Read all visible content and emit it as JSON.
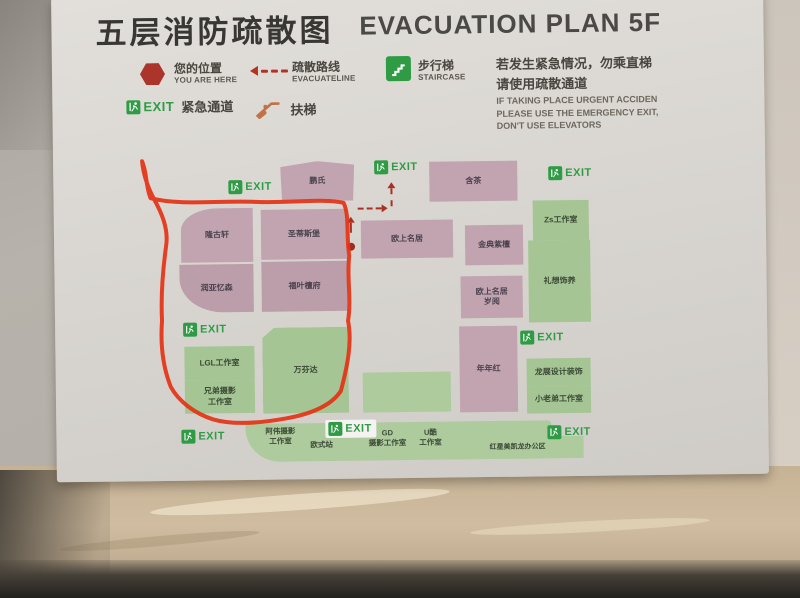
{
  "title": {
    "cn": "五层消防疏散图",
    "en": "EVACUATION PLAN 5F"
  },
  "legend": {
    "you_are_here_cn": "您的位置",
    "you_are_here_en": "YOU ARE HERE",
    "evacuate_line_cn": "疏散路线",
    "evacuate_line_en": "EVACUATELINE",
    "staircase_cn": "步行梯",
    "staircase_en": "STAIRCASE",
    "exit_word": "EXIT",
    "emergency_cn": "紧急通道",
    "escalator_cn": "扶梯"
  },
  "notice": {
    "cn": "若发生紧急情况，勿乘直梯\n请使用疏散通道",
    "en": "IF TAKING PLACE URGENT ACCIDEN\nPLEASE USE THE EMERGENCY EXIT,\nDON'T USE ELEVATORS"
  },
  "map": {
    "exit_label": "EXIT",
    "rooms": [
      {
        "label": "鹏氏"
      },
      {
        "label": "含茶"
      },
      {
        "label": "隆古轩"
      },
      {
        "label": "圣蒂斯堡"
      },
      {
        "label": "润亚忆森"
      },
      {
        "label": "福叶檀府"
      },
      {
        "label": "欧上名居"
      },
      {
        "label": "金典紫檀"
      },
      {
        "label": "欧上名居\n岁阅"
      },
      {
        "label": "年年红"
      },
      {
        "label": "Zs工作室"
      },
      {
        "label": "礼想饰养"
      },
      {
        "label": "龙展设计装饰"
      },
      {
        "label": "小老弟工作室"
      },
      {
        "label": "LGL工作室"
      },
      {
        "label": "兄弟摄影\n工作室"
      },
      {
        "label": "万芬达"
      },
      {
        "label": "阿伟摄影\n工作室"
      },
      {
        "label": "欧式站"
      },
      {
        "label": "GD\n摄影工作室"
      },
      {
        "label": "U酷\n工作室"
      },
      {
        "label": "红星美凯龙办公区"
      }
    ],
    "annotation": "hand-drawn red loop around left room cluster"
  },
  "colors": {
    "room_purple": "#c1a4b0",
    "room_green": "#a5c694",
    "exit_green": "#2f9c45",
    "marker_red": "#a93123",
    "annotation_red": "#e43214",
    "board_bg": "#d9d6d1",
    "wall_tan": "#c6b294"
  }
}
